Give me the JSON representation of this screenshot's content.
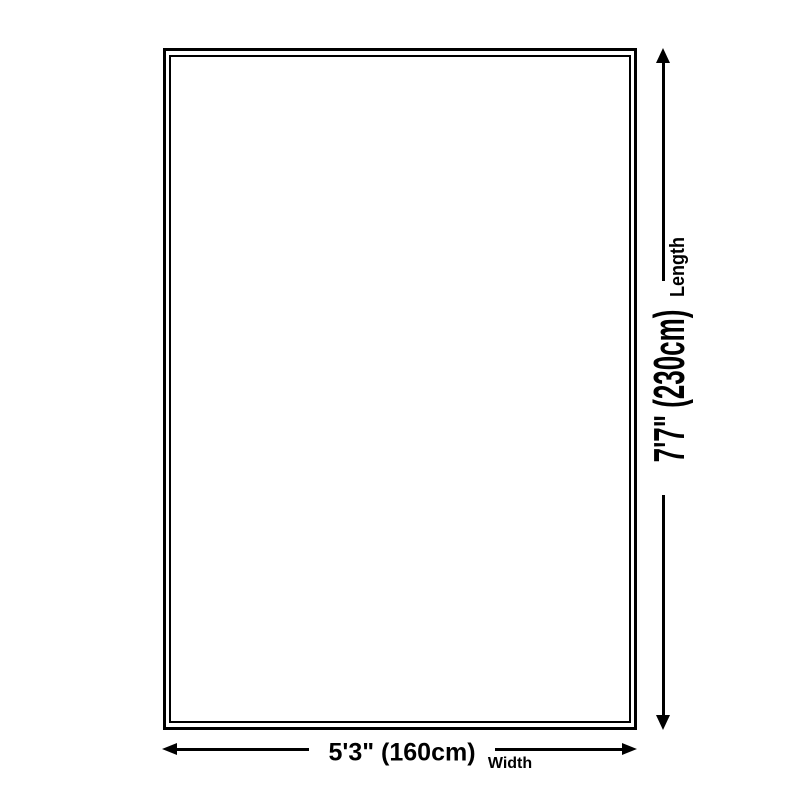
{
  "colors": {
    "background": "#ffffff",
    "ink": "#000000"
  },
  "diagram": {
    "type": "product-dimension-diagram",
    "shape": "rectangle-double-border",
    "length": {
      "label": "Length",
      "value": "7'7\" (230cm)",
      "cm": 230,
      "feet_inches": "7'7\""
    },
    "width": {
      "label": "Width",
      "value": "5'3\" (160cm)",
      "cm": 160,
      "feet_inches": "5'3\""
    }
  }
}
